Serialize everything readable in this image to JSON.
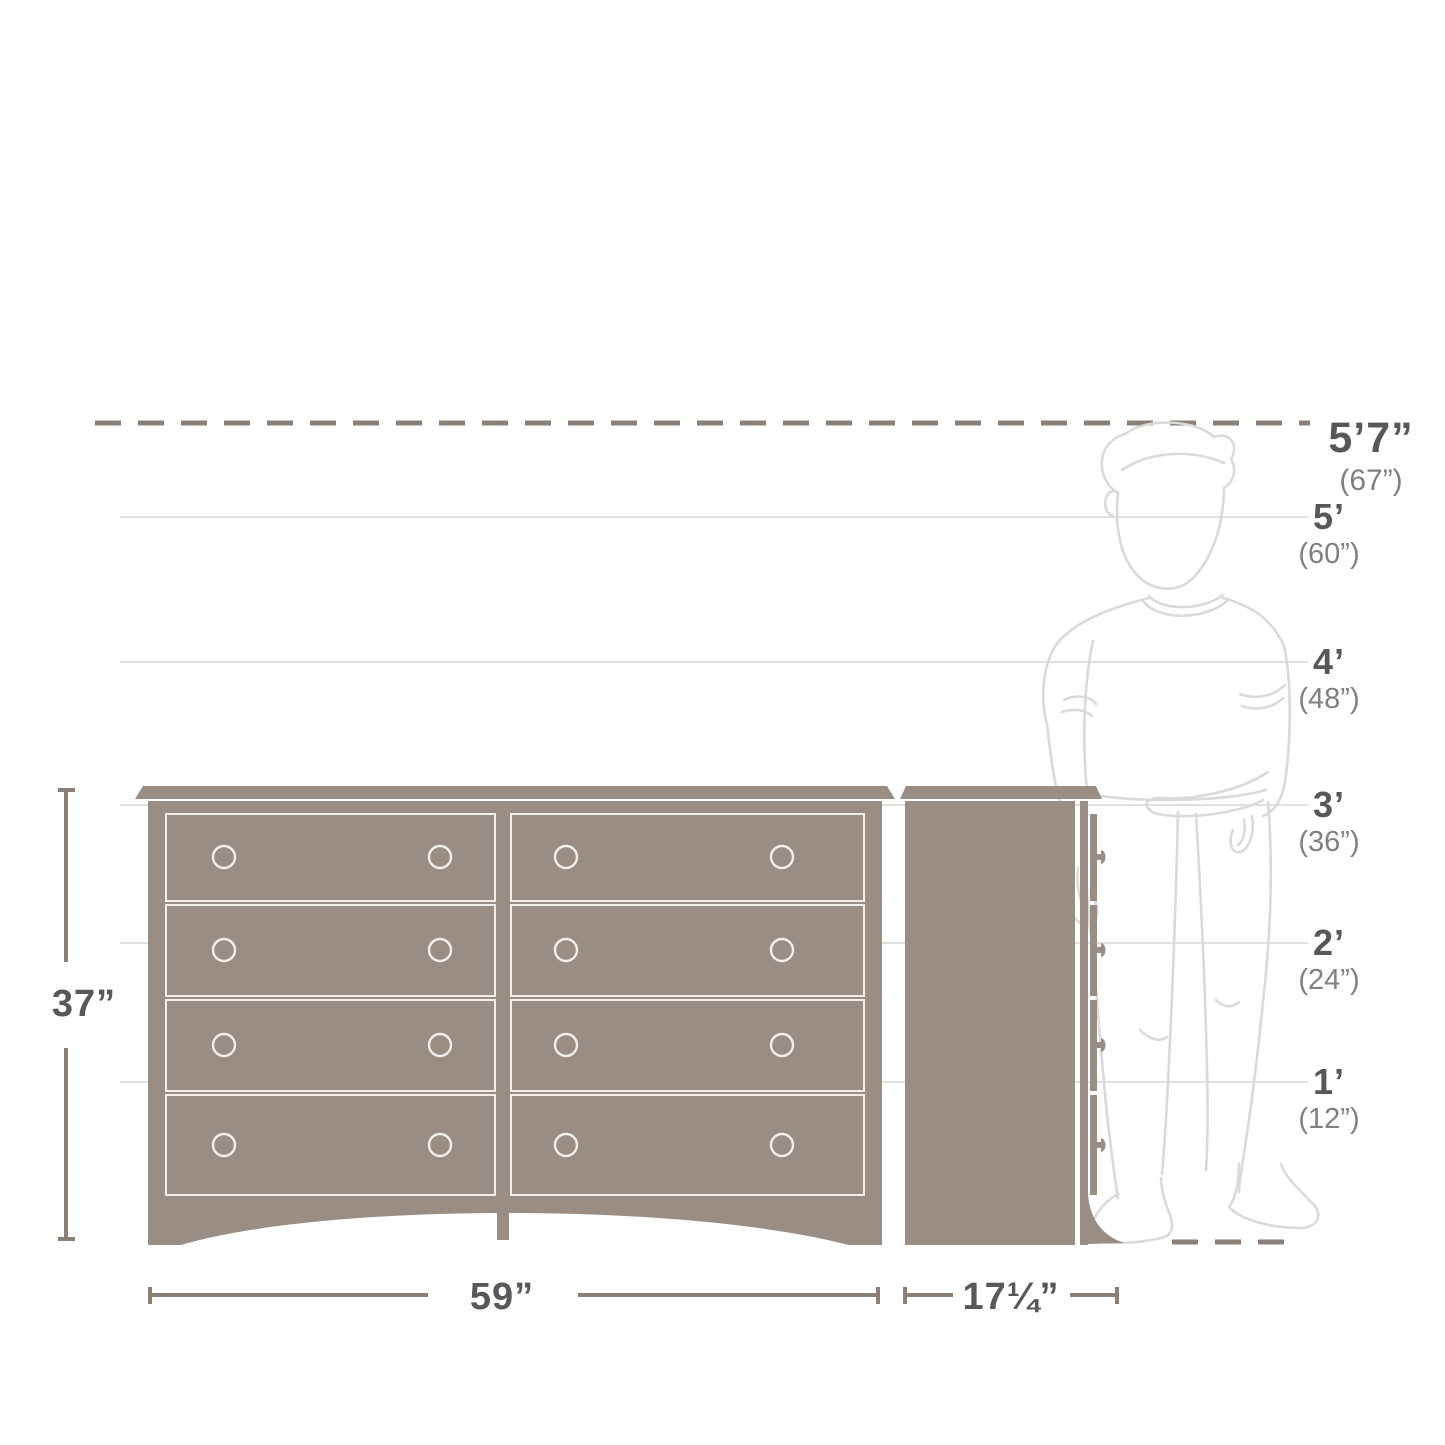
{
  "diagram_title": "dresser-size-reference-diagram",
  "colors": {
    "dresser_fill": "#9a8d83",
    "drawer_line": "#f2efeb",
    "grid_line": "#d7d5d2",
    "dash_line": "#8a8077",
    "dim_line": "#8b8076",
    "label": "#57585b",
    "sub_label": "#7e8083",
    "person_line": "#dcdad7"
  },
  "height_markers": [
    {
      "label": "5’7”",
      "sub": "(67”)"
    },
    {
      "label": "5’",
      "sub": "(60”)"
    },
    {
      "label": "4’",
      "sub": "(48”)"
    },
    {
      "label": "3’",
      "sub": "(36”)"
    },
    {
      "label": "2’",
      "sub": "(24”)"
    },
    {
      "label": "1’",
      "sub": "(12”)"
    }
  ],
  "dimensions": {
    "height": "37”",
    "width": "59”",
    "depth": "17¼”"
  },
  "icons": {
    "person": "standing-person-outline",
    "front_view": "dresser-front-view",
    "side_view": "dresser-side-view"
  }
}
